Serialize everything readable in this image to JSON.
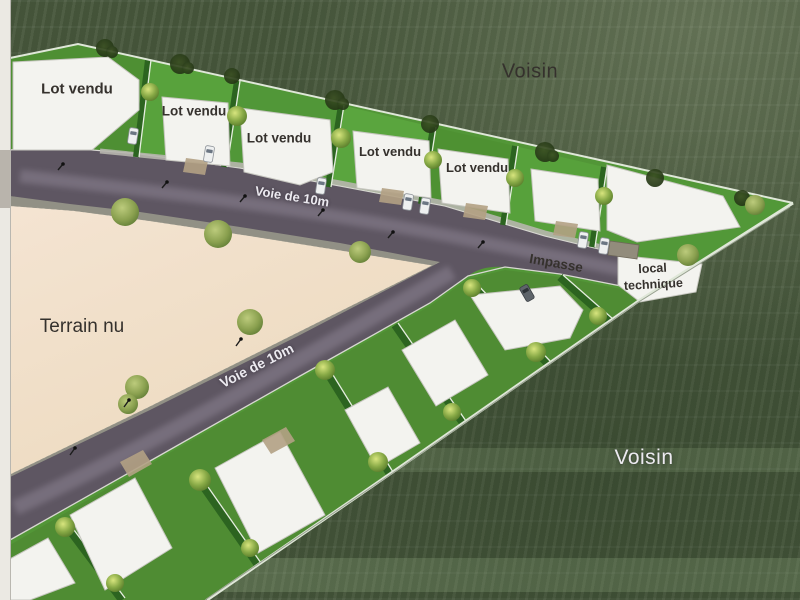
{
  "plan": {
    "neighbors": {
      "top": "Voisin",
      "bottom": "Voisin"
    },
    "terrain_label": "Terrain nu",
    "roads": {
      "main_label": "Voie de 10m",
      "secondary_label": "Voie de 10m",
      "impasse_label": "Impasse"
    },
    "technical_room": {
      "line1": "local",
      "line2": "technique"
    },
    "sold_lots": [
      "Lot vendu",
      "Lot vendu",
      "Lot vendu",
      "Lot vendu",
      "Lot vendu"
    ]
  },
  "palette": {
    "neighbor_grass": "#47573c",
    "parcel_grass": "#529637",
    "hedge_green": "#2c6420",
    "road_asphalt": "#5e5662",
    "road_sheen": "#9b93a3",
    "terrain_beige": "#f4e4d2",
    "plot_white": "#f3f3ef",
    "gravel": "#a8a79b",
    "boundary_line": "#dfe7d8",
    "label_dark": "#35312d",
    "label_light": "#eceaf0"
  }
}
